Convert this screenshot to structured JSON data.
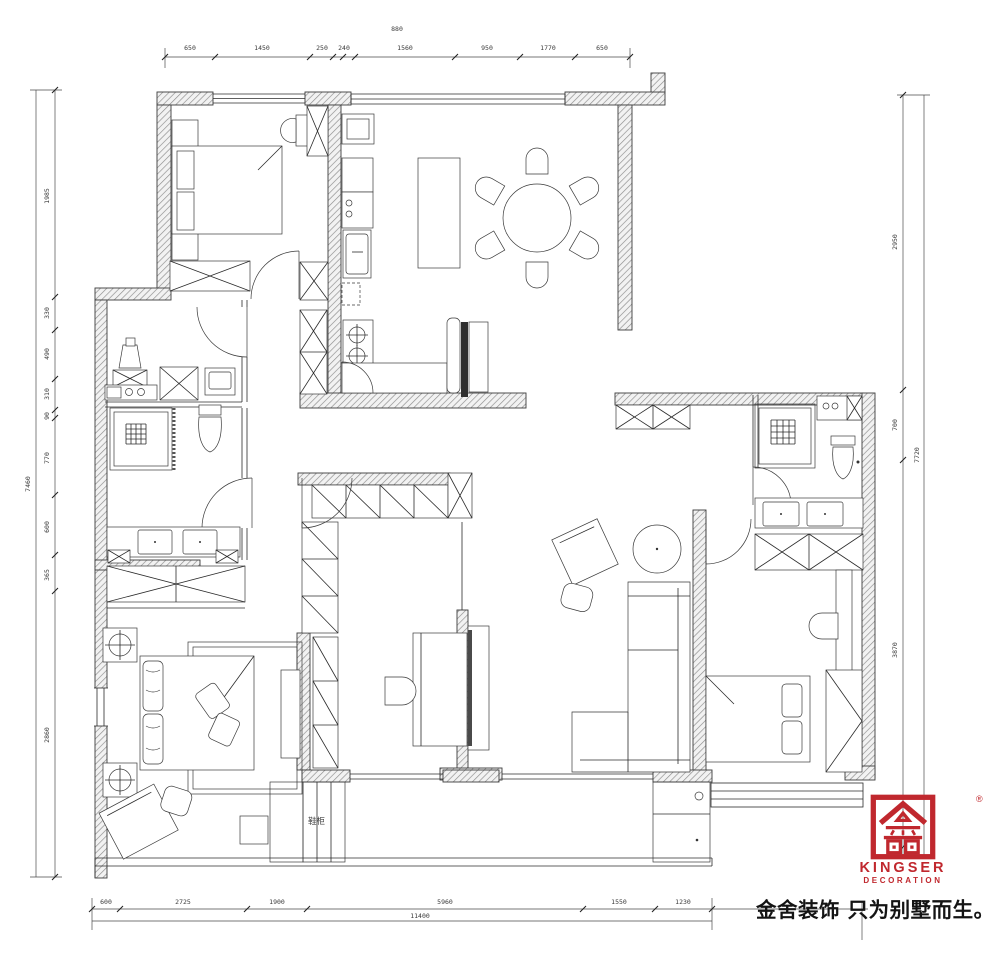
{
  "document": {
    "type": "residential floor plan drawing"
  },
  "dims": {
    "top": {
      "total": "880",
      "segs": [
        "650",
        "1450",
        "250",
        "240",
        "1560",
        "950",
        "1770",
        "650"
      ]
    },
    "left": {
      "total": "7460",
      "segs": [
        "1985",
        "330",
        "490",
        "310",
        "90",
        "770",
        "600",
        "365",
        "2860"
      ]
    },
    "right": {
      "total": "7720",
      "segs": [
        "2950",
        "700",
        "3870"
      ]
    },
    "bottom": {
      "total": "11400",
      "segs": [
        "600",
        "2725",
        "1900",
        "5960",
        "1550",
        "1230"
      ]
    }
  },
  "labels": {
    "balcony_cabinet": "鞋柜"
  },
  "logo": {
    "brand": "KINGSER",
    "subtitle": "DECORATION",
    "registered": "®",
    "slogan": "金舍装饰 只为别墅而生。",
    "color": "#c0282e"
  }
}
